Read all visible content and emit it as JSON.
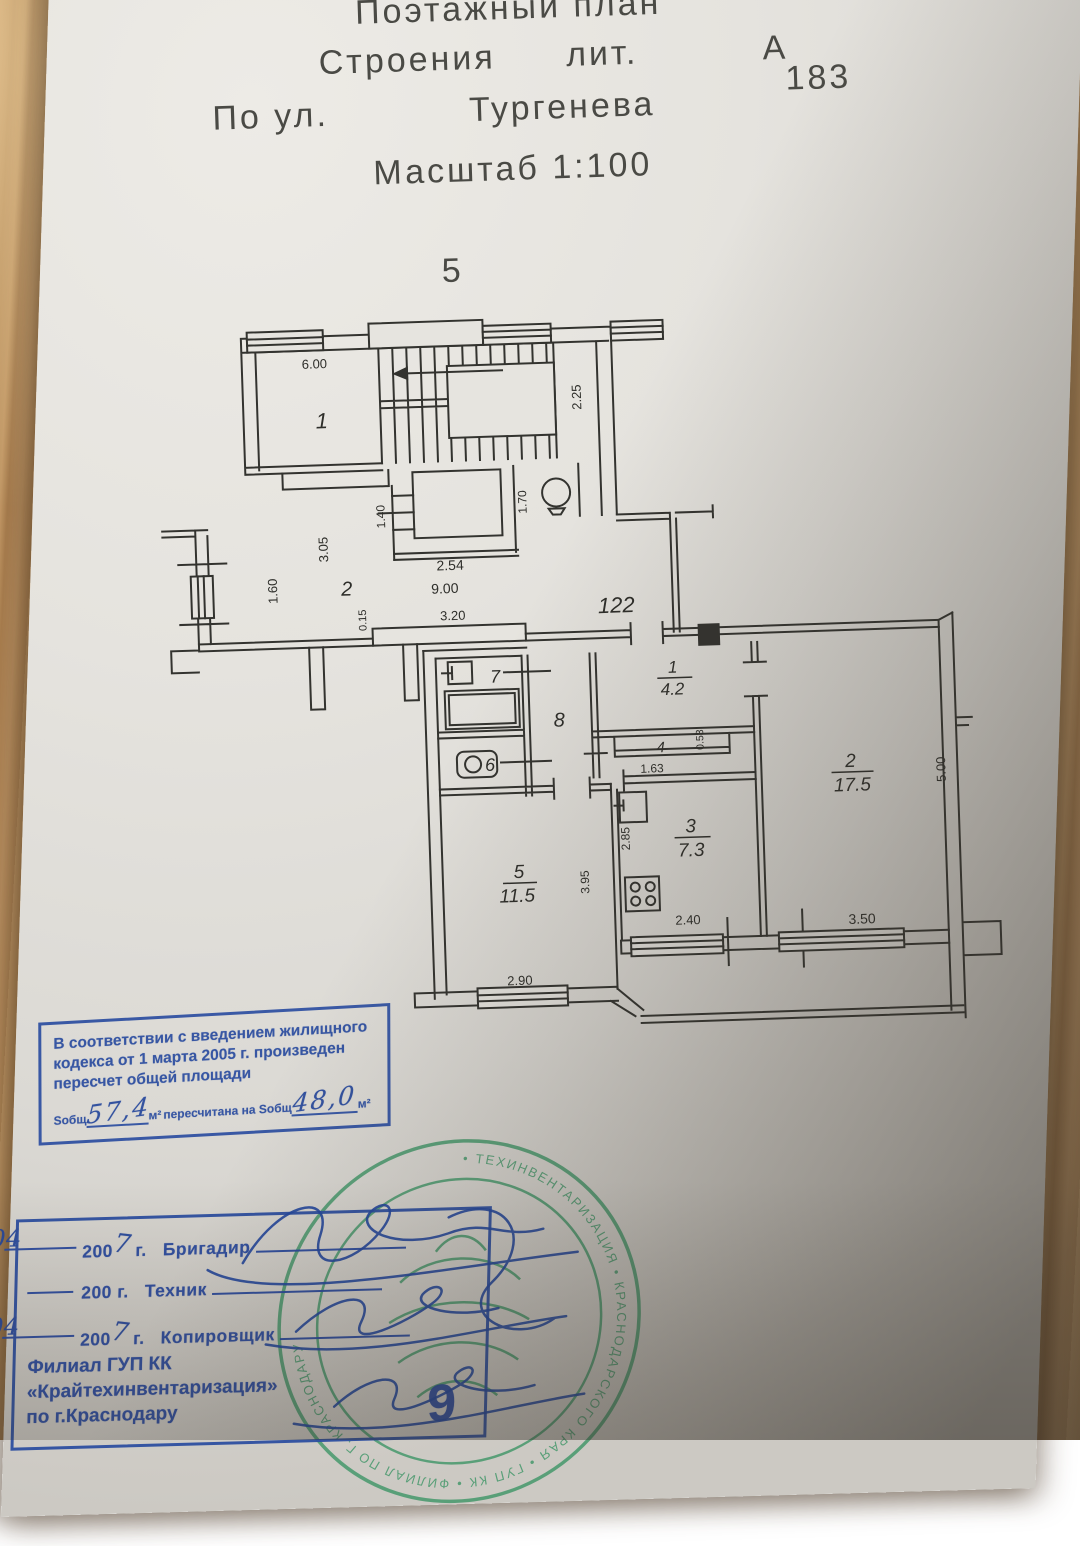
{
  "header": {
    "line1": "Поэтажный план",
    "line2_a": "Строения",
    "line2_b": "лит.",
    "line2_c": "А",
    "number": "183",
    "line3_a": "По ул.",
    "street": "Тургенева",
    "scale": "Масштаб 1:100",
    "floor": "5"
  },
  "plan": {
    "labels": {
      "stair_room": "1",
      "d600": "6.00",
      "d225": "2.25",
      "d140": "1.40",
      "d170": "1.70",
      "d305": "3.05",
      "d254": "2.54",
      "d900": "9.00",
      "corridor": "2",
      "d160": "1.60",
      "d015": "0.15",
      "d320": "3.20",
      "apt": "122",
      "hall_n": "1",
      "hall_a": "4.2",
      "closet": "4",
      "d053": "0.53",
      "d163": "1.63",
      "r2_n": "2",
      "r2_a": "17.5",
      "d500": "5.00",
      "kit_n": "3",
      "kit_a": "7.3",
      "d285": "2.85",
      "d240": "2.40",
      "r5_n": "5",
      "r5_a": "11.5",
      "d395": "3.95",
      "d290": "2.90",
      "d350": "3.50",
      "bath": "7",
      "hall8": "8",
      "wc": "6"
    }
  },
  "recalc_stamp": {
    "line1": "В соответствии с введением жилищного",
    "line2": "кодекса от 1 марта 2005 г. произведен",
    "line3": "пересчет общей площади",
    "s_label": "Sобщ",
    "old_value": "57,4",
    "m2": "м²",
    "mid_text": "пересчитана на Sобщ",
    "new_value": "48,0"
  },
  "bottom_stamp": {
    "date1": "05.04",
    "year_prefix": "200",
    "year_hand": "7",
    "g": "г.",
    "role1": "Бригадир",
    "role2": "Техник",
    "date3": "05.04",
    "role3": "Копировщик",
    "org1": "Филиал ГУП КК",
    "org2": "«Крайтехинвентаризация»",
    "org3": "по г.Краснодару",
    "big_number": "9"
  },
  "seal": {
    "ring_text": "• ТЕХИНВЕНТАРИЗАЦИЯ • КРАСНОДАРСКОГО КРАЯ • ГУП КК • ФИЛИАЛ ПО Г. КРАСНОДАРУ"
  }
}
